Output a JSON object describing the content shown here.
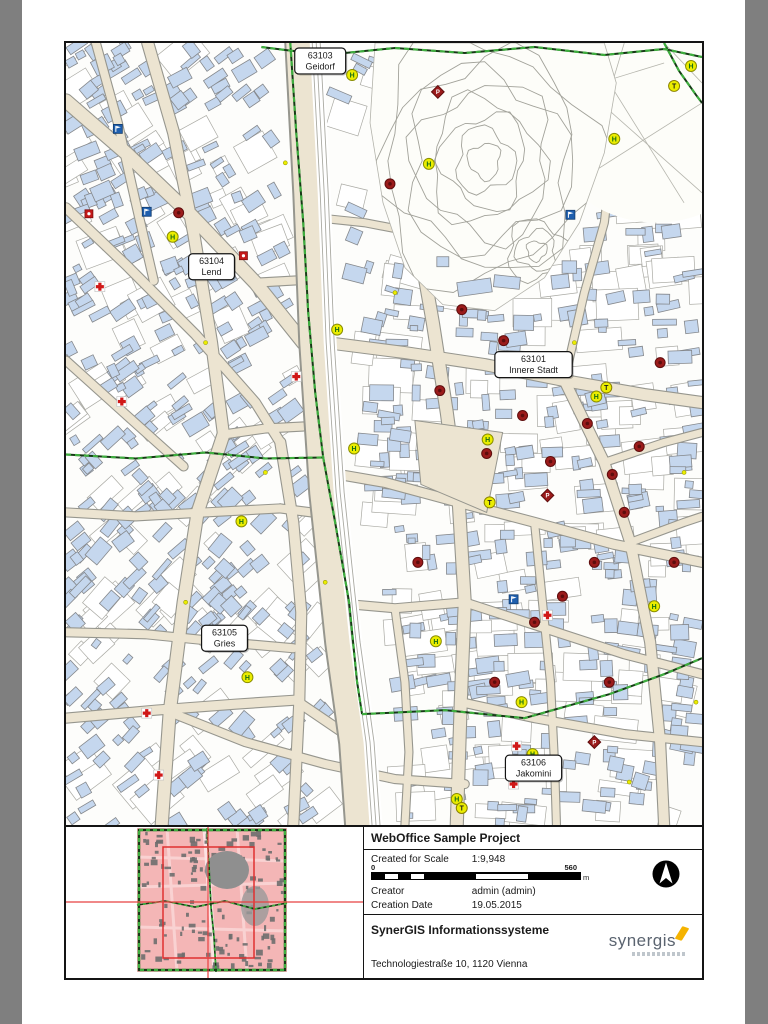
{
  "page": {
    "background": "#7f7f7f",
    "paper": "#ffffff"
  },
  "map": {
    "district_labels": [
      {
        "id": "63103",
        "name": "Geidorf",
        "x": 255,
        "y": 18
      },
      {
        "id": "63104",
        "name": "Lend",
        "x": 146,
        "y": 224
      },
      {
        "id": "63101",
        "name": "Innere Stadt",
        "x": 469,
        "y": 322
      },
      {
        "id": "63105",
        "name": "Gries",
        "x": 159,
        "y": 596
      },
      {
        "id": "63106",
        "name": "Jakomini",
        "x": 469,
        "y": 726
      }
    ],
    "marker_glyphs": {
      "transit": "H",
      "taxi": "T",
      "parking": "P"
    },
    "markers": {
      "transit_stops": [
        [
          287,
          32
        ],
        [
          364,
          121
        ],
        [
          550,
          96
        ],
        [
          627,
          23
        ],
        [
          107,
          194
        ],
        [
          272,
          287
        ],
        [
          532,
          354
        ],
        [
          423,
          397
        ],
        [
          289,
          406
        ],
        [
          176,
          479
        ],
        [
          371,
          599
        ],
        [
          590,
          564
        ],
        [
          457,
          660
        ],
        [
          468,
          712
        ],
        [
          392,
          757
        ],
        [
          182,
          635
        ]
      ],
      "taxi_stands": [
        [
          610,
          43
        ],
        [
          542,
          345
        ],
        [
          425,
          460
        ],
        [
          397,
          766
        ]
      ],
      "poi_circles": [
        [
          325,
          141
        ],
        [
          397,
          267
        ],
        [
          439,
          298
        ],
        [
          375,
          348
        ],
        [
          422,
          411
        ],
        [
          458,
          373
        ],
        [
          486,
          419
        ],
        [
          523,
          381
        ],
        [
          548,
          432
        ],
        [
          575,
          404
        ],
        [
          596,
          320
        ],
        [
          560,
          470
        ],
        [
          530,
          520
        ],
        [
          498,
          554
        ],
        [
          470,
          580
        ],
        [
          545,
          640
        ],
        [
          610,
          520
        ],
        [
          113,
          170
        ],
        [
          353,
          520
        ],
        [
          430,
          640
        ]
      ],
      "poi_diamonds": [
        [
          373,
          49
        ],
        [
          483,
          453
        ],
        [
          530,
          700
        ]
      ],
      "pharmacies": [
        [
          34,
          244
        ],
        [
          231,
          334
        ],
        [
          56,
          359
        ],
        [
          81,
          671
        ],
        [
          93,
          733
        ],
        [
          452,
          704
        ],
        [
          483,
          573
        ],
        [
          449,
          742
        ]
      ],
      "info_points": [
        [
          52,
          86
        ],
        [
          81,
          169
        ],
        [
          506,
          172
        ],
        [
          449,
          557
        ]
      ],
      "red_squares": [
        [
          23,
          171
        ],
        [
          178,
          213
        ]
      ],
      "small_dots": [
        [
          220,
          120
        ],
        [
          140,
          300
        ],
        [
          260,
          540
        ],
        [
          330,
          250
        ],
        [
          510,
          300
        ],
        [
          620,
          430
        ],
        [
          200,
          430
        ],
        [
          120,
          560
        ],
        [
          565,
          740
        ],
        [
          632,
          660
        ]
      ]
    },
    "palette": {
      "building": "#c5d7ee",
      "building_stroke": "#85888c",
      "street": "#ece4d1",
      "street_casing": "#96968e",
      "parcel_stroke": "#aaaaa4",
      "hill_contour": "#a2a29a",
      "boundary_green": "#3fae3f",
      "boundary_dark": "#163a16",
      "marker_yellow": "#ebed00",
      "marker_red": "#9b1b1b",
      "marker_blue": "#1f5fae",
      "cross_red": "#d01818",
      "overview_pink": "#f4b6b6",
      "overview_gray": "#6e6e6e",
      "extent_red": "#e03030",
      "crosshair_red": "#e84040"
    }
  },
  "info_panel": {
    "title": "WebOffice Sample Project",
    "rows": [
      {
        "label": "Created for Scale",
        "value": "1:9,948"
      },
      {
        "label": "Creator",
        "value": "admin (admin)"
      },
      {
        "label": "Creation Date",
        "value": "19.05.2015"
      }
    ],
    "scalebar": {
      "start": "0",
      "end": "560",
      "unit": "m"
    },
    "company": {
      "name": "SynerGIS Informationssysteme",
      "address": "Technologiestraße 10, 1120 Vienna"
    },
    "logo": {
      "text": "synergis",
      "accent": "#f5b300"
    }
  }
}
